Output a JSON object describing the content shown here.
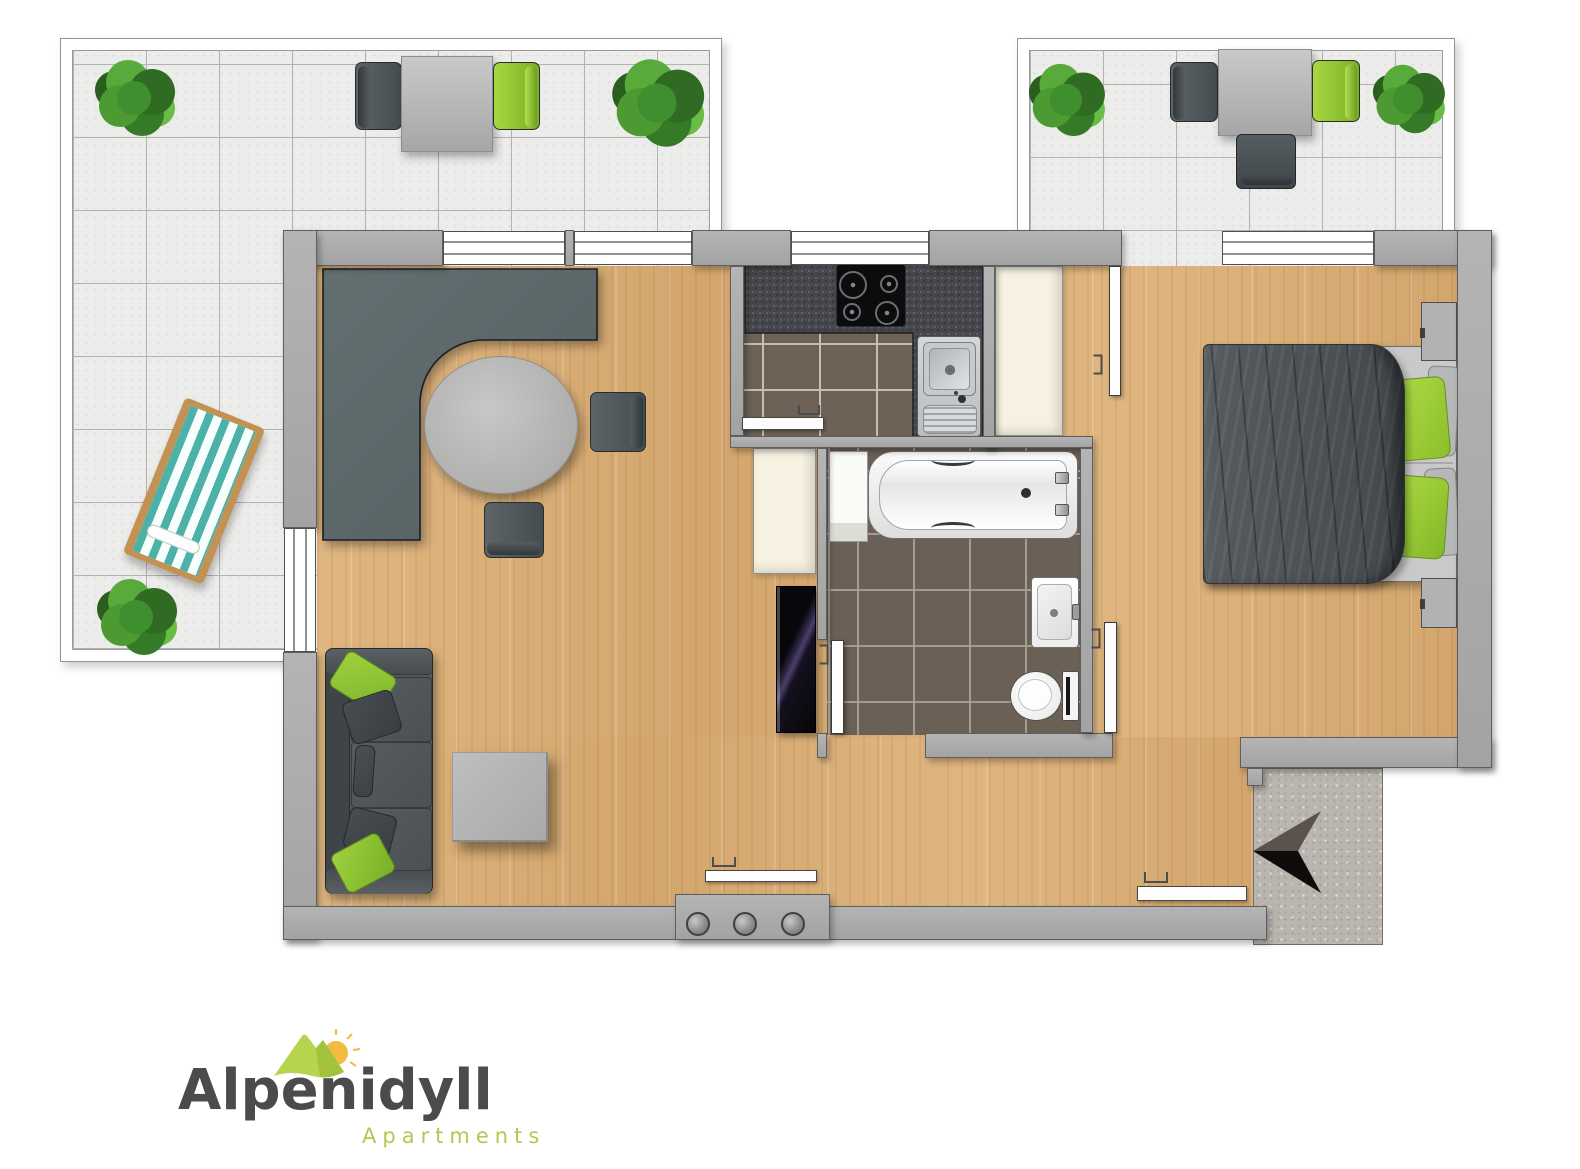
{
  "meta": {
    "type": "apartment-floor-plan",
    "orientation_arrow": "points-left"
  },
  "brand": {
    "name": "Alpenidyll",
    "subtitle": "Apartments"
  },
  "colors": {
    "wall": "#acacac",
    "wood-1": "#e0b680",
    "wood-2": "#d2a66d",
    "tile": "#ececea",
    "grout": "#b2b2b2",
    "ktile": "#6e6257",
    "kgrout": "#c6bcb0",
    "btile": "#6a6056",
    "bgrout": "#a59c90",
    "counter": "#46474c",
    "cream": "#f6f1e1",
    "sofa": "#51575b",
    "sofa-dark": "#3e4447",
    "pillow-green": "#8cc63f",
    "duvet": "#4c5256",
    "mattress": "#c9c9c9",
    "table-gray": "#bdbdbb",
    "chair-dark": "#4e575b",
    "chair-green": "#8cc63e",
    "teal": "#4cb2a8",
    "frame-wood": "#c19254",
    "entrance-floor": "#bab5ae",
    "arrow-top": "#5a524c",
    "arrow-bottom": "#0f0d0b",
    "logo-text": "#4b4b4d",
    "logo-green": "#b6d44e",
    "logo-subtitle": "#aeca50",
    "sun": "#f2bc42"
  },
  "rooms": [
    {
      "id": "terrace-left",
      "furniture": [
        "plant",
        "plant",
        "plant",
        "outdoor-table",
        "outdoor-chair-dark",
        "outdoor-chair-green",
        "deck-lounger"
      ]
    },
    {
      "id": "terrace-right",
      "furniture": [
        "plant",
        "plant",
        "outdoor-table",
        "outdoor-chair-dark",
        "outdoor-chair-green",
        "outdoor-lounge-chair"
      ]
    },
    {
      "id": "living-room",
      "furniture": [
        "corner-desk",
        "round-table",
        "desk-chair",
        "desk-chair",
        "sofa",
        "coffee-table",
        "sliding-door",
        "coat-hooks"
      ]
    },
    {
      "id": "kitchen",
      "furniture": [
        "counter",
        "cooktop",
        "sink",
        "sliding-door"
      ]
    },
    {
      "id": "bathroom",
      "furniture": [
        "bathtub",
        "washbasin",
        "toilet",
        "shelf",
        "door"
      ]
    },
    {
      "id": "bedroom",
      "furniture": [
        "double-bed",
        "nightstand",
        "nightstand",
        "terrace-door",
        "window"
      ]
    },
    {
      "id": "hallway",
      "furniture": [
        "wardrobe",
        "wardrobe",
        "sliding-glass-door",
        "entrance-door"
      ]
    },
    {
      "id": "entrance",
      "furniture": [
        "north-arrow"
      ]
    }
  ]
}
